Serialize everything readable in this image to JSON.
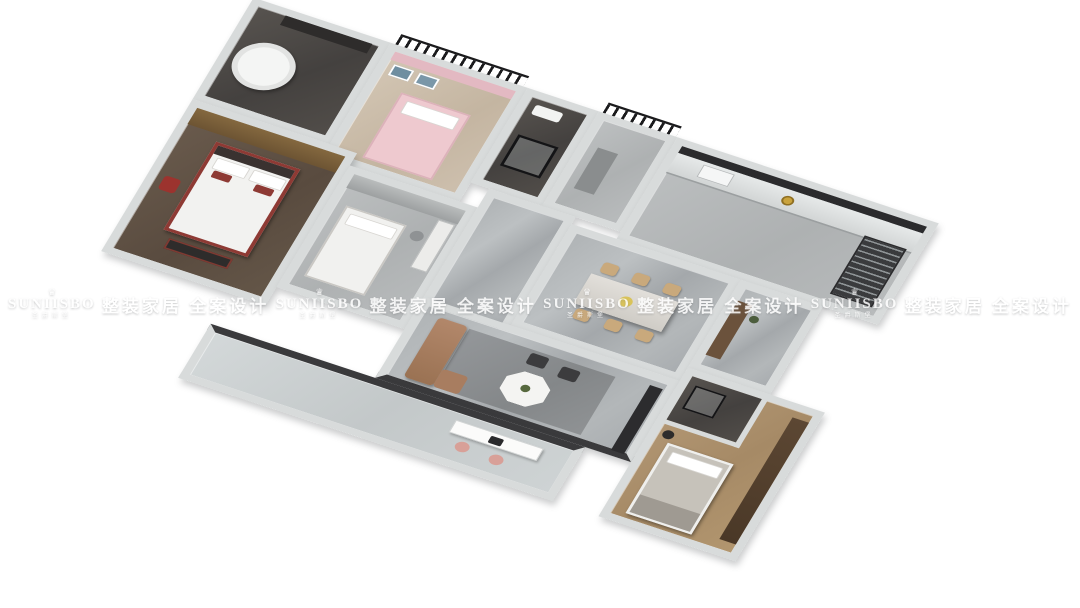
{
  "watermark": {
    "brand": "SUNIISBO",
    "brand_chinese": "圣爵斯堡",
    "slogan": "整装家居 全案设计",
    "crown_glyph": "♛",
    "text_color": "#ffffff",
    "repeat_pattern": [
      "logo",
      "slogan",
      "logo",
      "slogan",
      "logo",
      "slogan",
      "logo",
      "slogan"
    ]
  },
  "scene": {
    "description": "3D isometric render of a three-bedroom apartment floor plan, rotated clockwise on a white background",
    "rooms": [
      {
        "name": "master-bathroom",
        "feature": "white corner bathtub on dark tile"
      },
      {
        "name": "kids-bedroom",
        "feature": "pink bed, pink curtains, wall art"
      },
      {
        "name": "shower-bathroom",
        "feature": "black-framed glass shower"
      },
      {
        "name": "entry-hall",
        "feature": "grey tile, balcony railing outside"
      },
      {
        "name": "kitchen",
        "feature": "counter with window band, gold sink, steel appliance tower"
      },
      {
        "name": "master-bedroom",
        "feature": "white bed with red frame and pillows, wood wardrobe"
      },
      {
        "name": "study-bedroom",
        "feature": "white bed, desk and shelving"
      },
      {
        "name": "hallway",
        "feature": "grey marble floor"
      },
      {
        "name": "dining-room",
        "feature": "rectangular table with six tan chairs and yellow flowers"
      },
      {
        "name": "corridor",
        "feature": "wood sideboard and plant"
      },
      {
        "name": "living-room",
        "feature": "tan leather sofa, grey rug, white octagonal coffee table, two dark ottomans, dark TV cabinet"
      },
      {
        "name": "guest-bedroom",
        "feature": "wood floor, grey bed, dark ensuite shower room, wardrobe, floor lamp"
      },
      {
        "name": "balcony",
        "feature": "long glazed balcony with white desk, laptop and two pink chairs"
      }
    ],
    "palette": {
      "background": "#ffffff",
      "wall": "#d8dbdb",
      "marble_floor": "#aaaeb1",
      "dark_tile": "#4a4745",
      "wood_floor": "#ab9070",
      "pink_accent": "#e9c6cb",
      "red_accent": "#8e3a34",
      "tan_chair": "#c9a97c",
      "sofa_leather": "#a87d60",
      "gold_fixture": "#c9a23c",
      "railing_black": "#1b1b1d"
    }
  }
}
